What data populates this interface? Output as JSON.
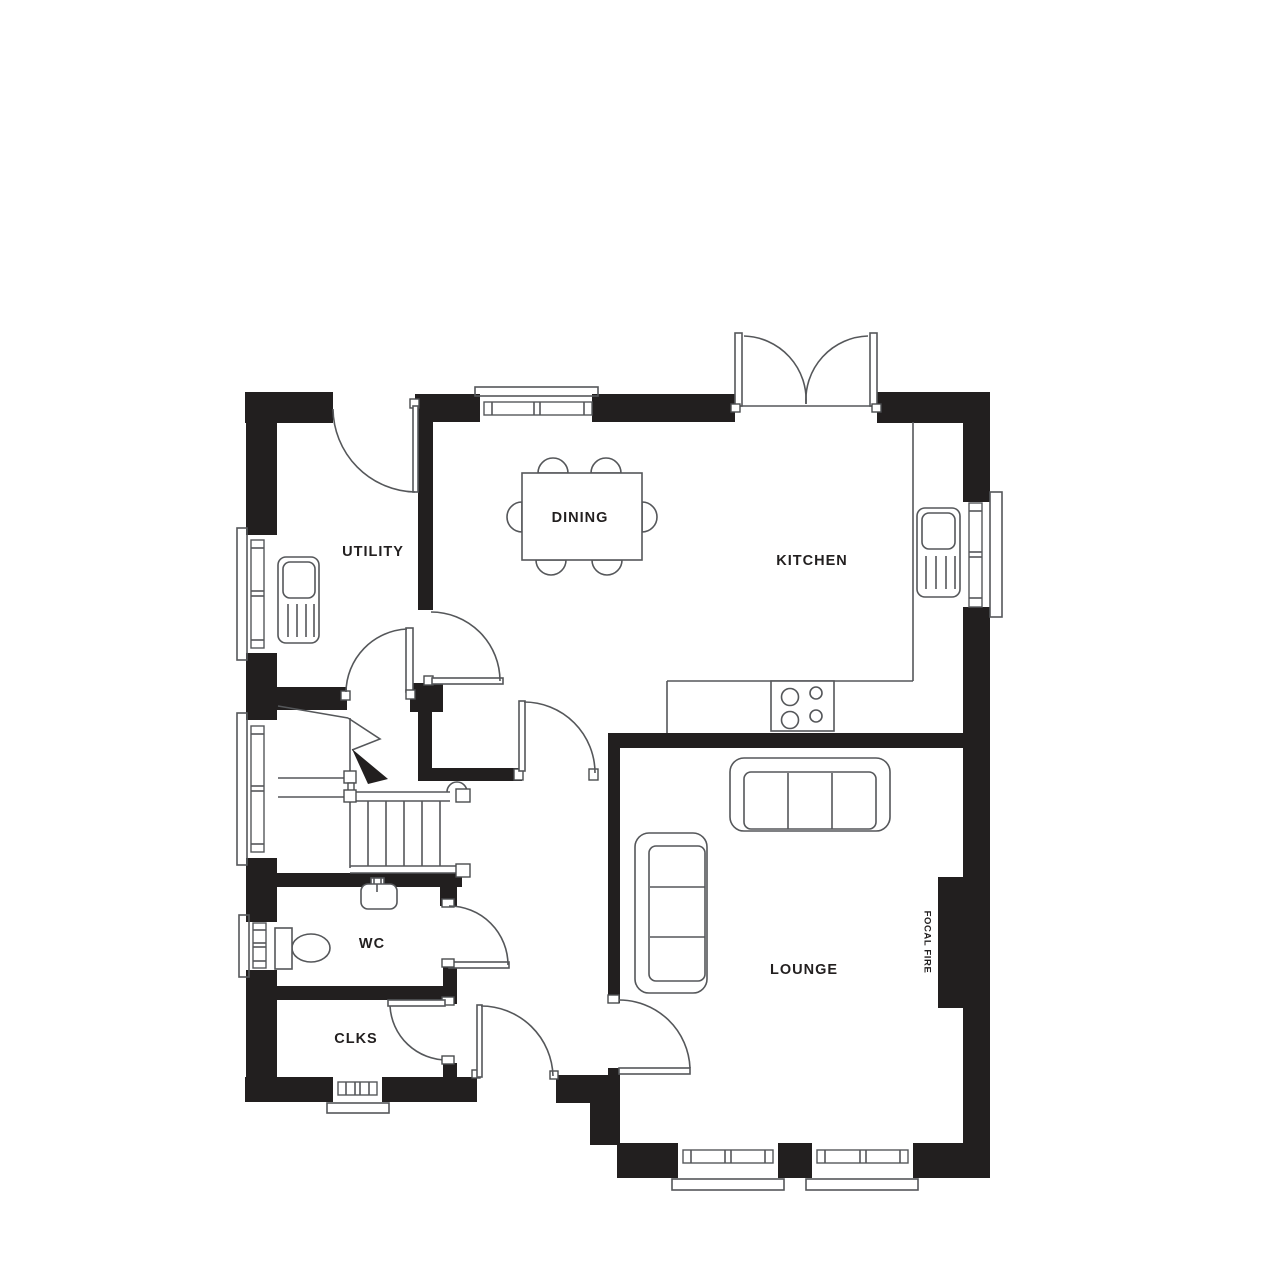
{
  "page": {
    "background": "#ffffff"
  },
  "colors": {
    "wall": "#221f1f",
    "line": "#55575a",
    "label": "#221f1f"
  },
  "rooms": [
    {
      "name": "utility",
      "label": "UTILITY"
    },
    {
      "name": "dining",
      "label": "DINING"
    },
    {
      "name": "kitchen",
      "label": "KITCHEN"
    },
    {
      "name": "wc",
      "label": "WC"
    },
    {
      "name": "clks",
      "label": "CLKS"
    },
    {
      "name": "lounge",
      "label": "LOUNGE"
    }
  ],
  "annotations": [
    {
      "name": "focal-fire",
      "label": "FOCAL FIRE"
    }
  ],
  "fixtures": [
    "dining-table-six-chairs",
    "kitchen-sink",
    "utility-sink",
    "hob-four-burners",
    "wc-basin",
    "toilet",
    "sofa-three-seat-top",
    "sofa-three-seat-left",
    "staircase",
    "french-doors",
    "focal-fire-chimney-breast"
  ]
}
